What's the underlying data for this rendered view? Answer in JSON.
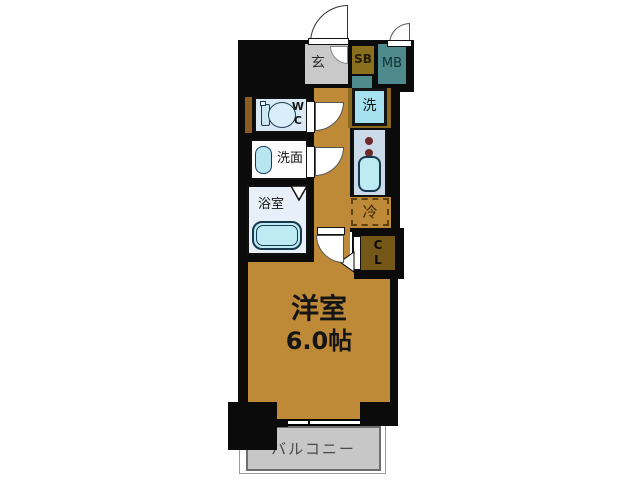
{
  "plan": {
    "entrance": {
      "label": "玄"
    },
    "shoe_box": {
      "label": "SB"
    },
    "meter_box": {
      "label": "MB"
    },
    "washing_machine": {
      "label": "洗"
    },
    "toilet": {
      "line1": "W",
      "line2": "C"
    },
    "washroom": {
      "label": "洗面"
    },
    "bathroom": {
      "label": "浴室"
    },
    "kitchen": {
      "burners": "2"
    },
    "refrigerator": {
      "label": "冷"
    },
    "closet": {
      "line1": "C",
      "line2": "L"
    },
    "main_room": {
      "name": "洋室",
      "size": "6.0帖"
    },
    "balcony": {
      "label": "バルコニー"
    }
  },
  "colors": {
    "wall": "#0b0b0b",
    "room_floor": "#BE8A38",
    "entrance_floor": "#C9C9C9",
    "shoe_box": "#8A6F1E",
    "shoe_box_shelf": "#4F8B8D",
    "meter_box": "#4E898B",
    "washer_pan": "#8A681E",
    "washer": "#A6E1EF",
    "counter": "#CBDAE9",
    "water_fixture": "#BEEAF4",
    "toilet_room": "#D9E9F6",
    "washroom_bg": "#FCFCFC",
    "bathroom_bg": "#E7F0F8",
    "closet": "#755818",
    "pipe_space": "#8A5C20",
    "balcony": "#C7C7C7"
  }
}
